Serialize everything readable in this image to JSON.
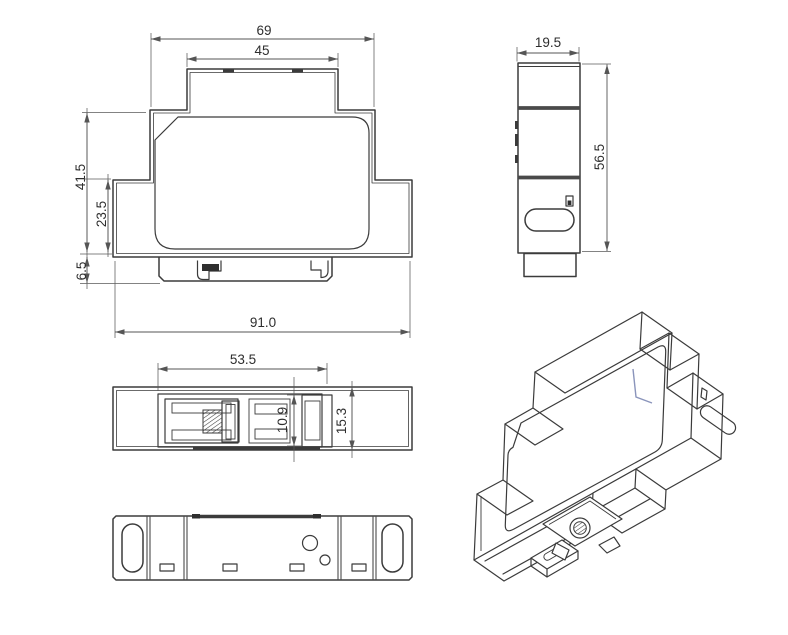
{
  "drawing": {
    "type": "technical-dimension-drawing",
    "subject": "DIN-rail mount enclosure",
    "units": "mm",
    "background": "#ffffff",
    "line_color": "#3b3b3b",
    "dimension_color": "#555555",
    "accent_color": "#8a94bb",
    "views": {
      "front": {
        "label": "front-view",
        "dimensions": {
          "upper_body_width": "69",
          "top_block_width": "45",
          "body_height": "41.5",
          "lower_body_height": "23.5",
          "foot_height": "6.5",
          "overall_width": "91.0"
        }
      },
      "side": {
        "label": "side-view",
        "dimensions": {
          "depth": "19.5",
          "overall_height": "56.5"
        }
      },
      "bottom": {
        "label": "bottom-view-din-clip",
        "dimensions": {
          "clip_length": "53.5",
          "rail_slot_width": "10.9",
          "clip_overall_width": "15.3"
        }
      },
      "top": {
        "label": "top-view"
      },
      "isometric": {
        "label": "isometric-view"
      }
    }
  }
}
